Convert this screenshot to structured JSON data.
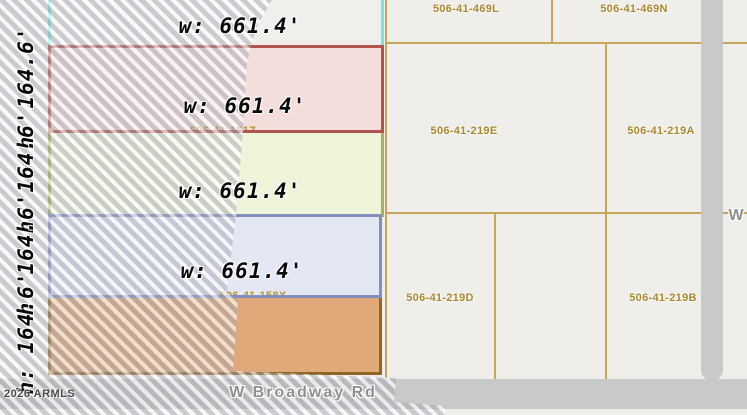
{
  "map": {
    "dimension_labels": {
      "width": "w: 661.4'",
      "height": "h: 164.6'"
    },
    "right_parcel_ids": [
      "506-41-469L",
      "506-41-469N",
      "506-41-219E",
      "506-41-219A",
      "506-41-219D",
      "506-41-219B"
    ],
    "hidden_parcel_ids": [
      "506-41-151Z",
      "506-41-158X"
    ],
    "roads": {
      "bottom_road": "W Broadway Rd",
      "right_edge_partial": "W"
    },
    "watermark": "2026 ARMLS",
    "colors": {
      "cyan_parcel_border": "#7ee2e0",
      "red_parcel_border": "#b1534e",
      "red_parcel_fill": "#f3dedb",
      "green_parcel_border": "#a8b063",
      "green_parcel_fill": "#eef4da",
      "blue_parcel_border": "#8290c0",
      "blue_parcel_fill": "#e3e8f4",
      "orange_parcel_border": "#8f6626",
      "orange_parcel_fill": "#dfa97a",
      "boundary_line": "#c9a55a",
      "parcel_id_text": "#a8872f",
      "road_fill": "#c9c9c9",
      "road_text": "#8f8f8f"
    }
  }
}
